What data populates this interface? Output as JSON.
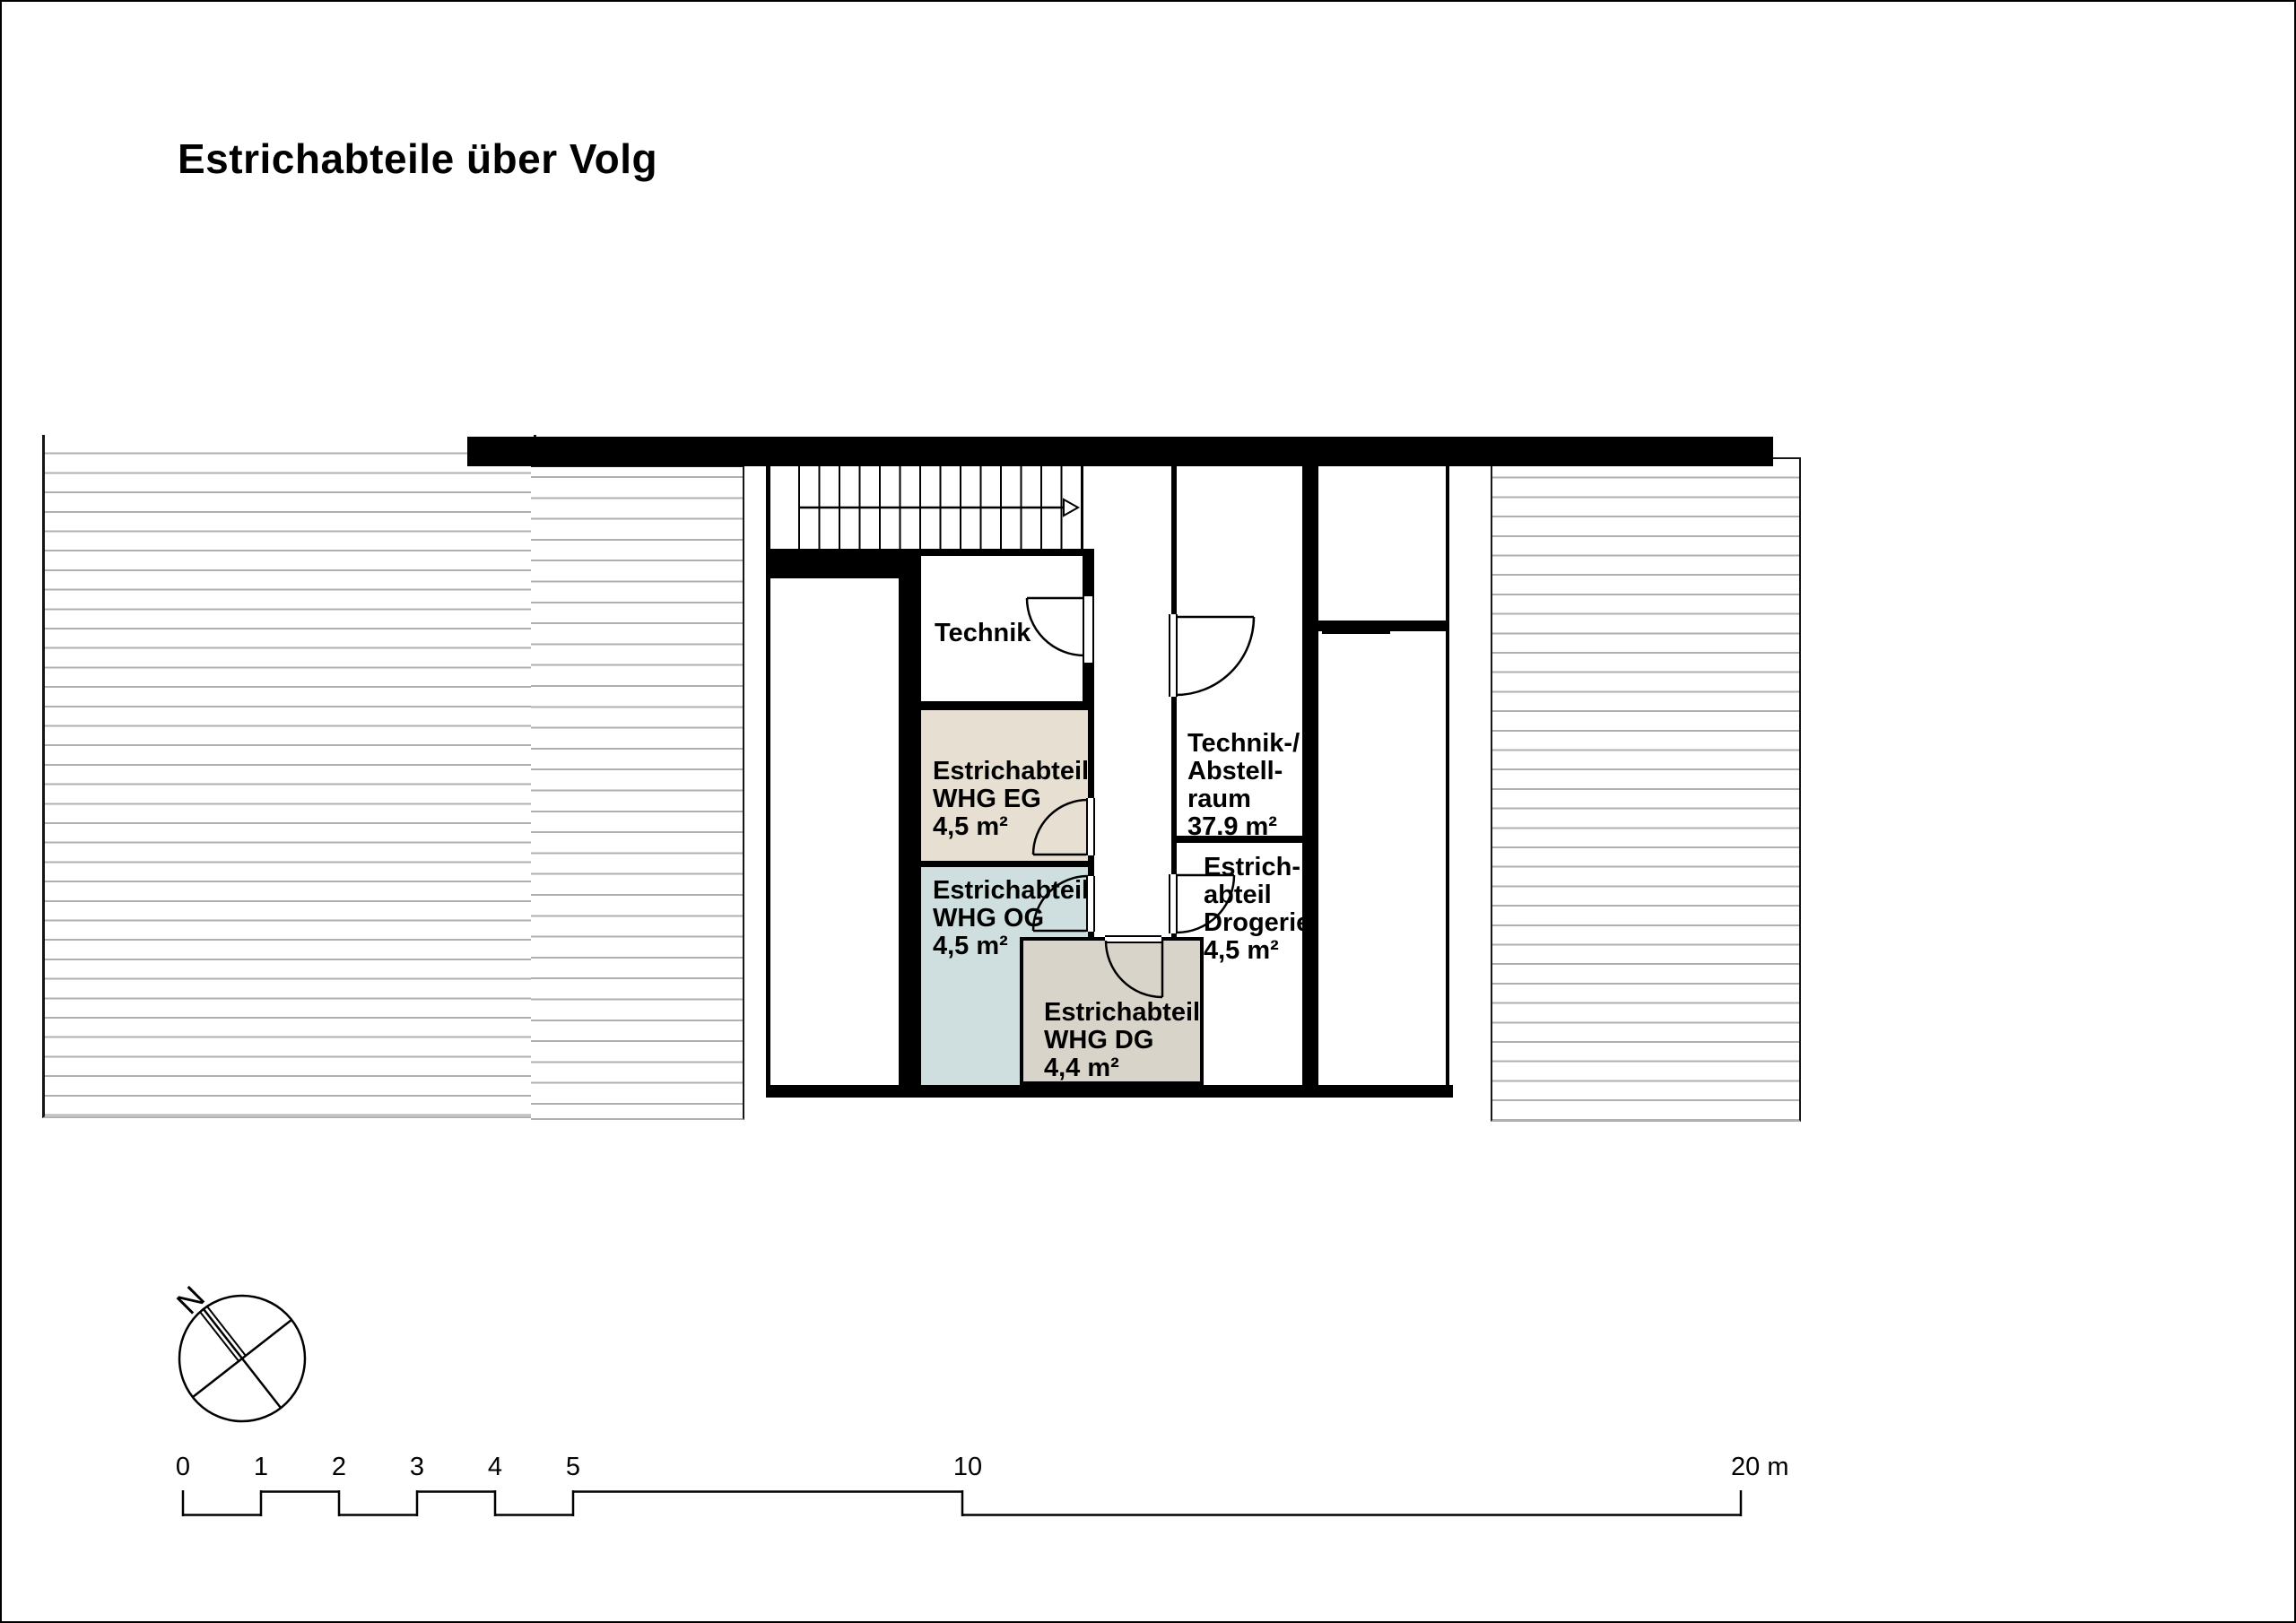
{
  "title": "Estrichabteile über Volg",
  "plan": {
    "rooms": {
      "technik": {
        "label": "Technik"
      },
      "estrich_eg": {
        "lines": [
          "Estrichabteil",
          "WHG EG",
          "4,5 m²"
        ],
        "fill": "#e7e0d2"
      },
      "estrich_og": {
        "lines": [
          "Estrichabteil",
          "WHG OG",
          "4,5 m²"
        ],
        "fill": "#cfdfdf"
      },
      "estrich_dg": {
        "lines": [
          "Estrichabteil",
          "WHG DG",
          "4,4 m²"
        ],
        "fill": "#d9d4ca"
      },
      "technik_abstellraum": {
        "lines": [
          "Technik-/",
          "Abstell-",
          "raum",
          "37.9 m²"
        ]
      },
      "estrich_drogerie": {
        "lines": [
          "Estrich-",
          "abteil",
          "Drogerie",
          "4,5 m²"
        ]
      }
    },
    "colors": {
      "wall": "#000000",
      "hatch_line": "#b0b0b0"
    }
  },
  "compass": {
    "north_label": "N"
  },
  "scale_bar": {
    "tick_labels": [
      "0",
      "1",
      "2",
      "3",
      "4",
      "5",
      "10"
    ],
    "end_label": "20 m"
  }
}
